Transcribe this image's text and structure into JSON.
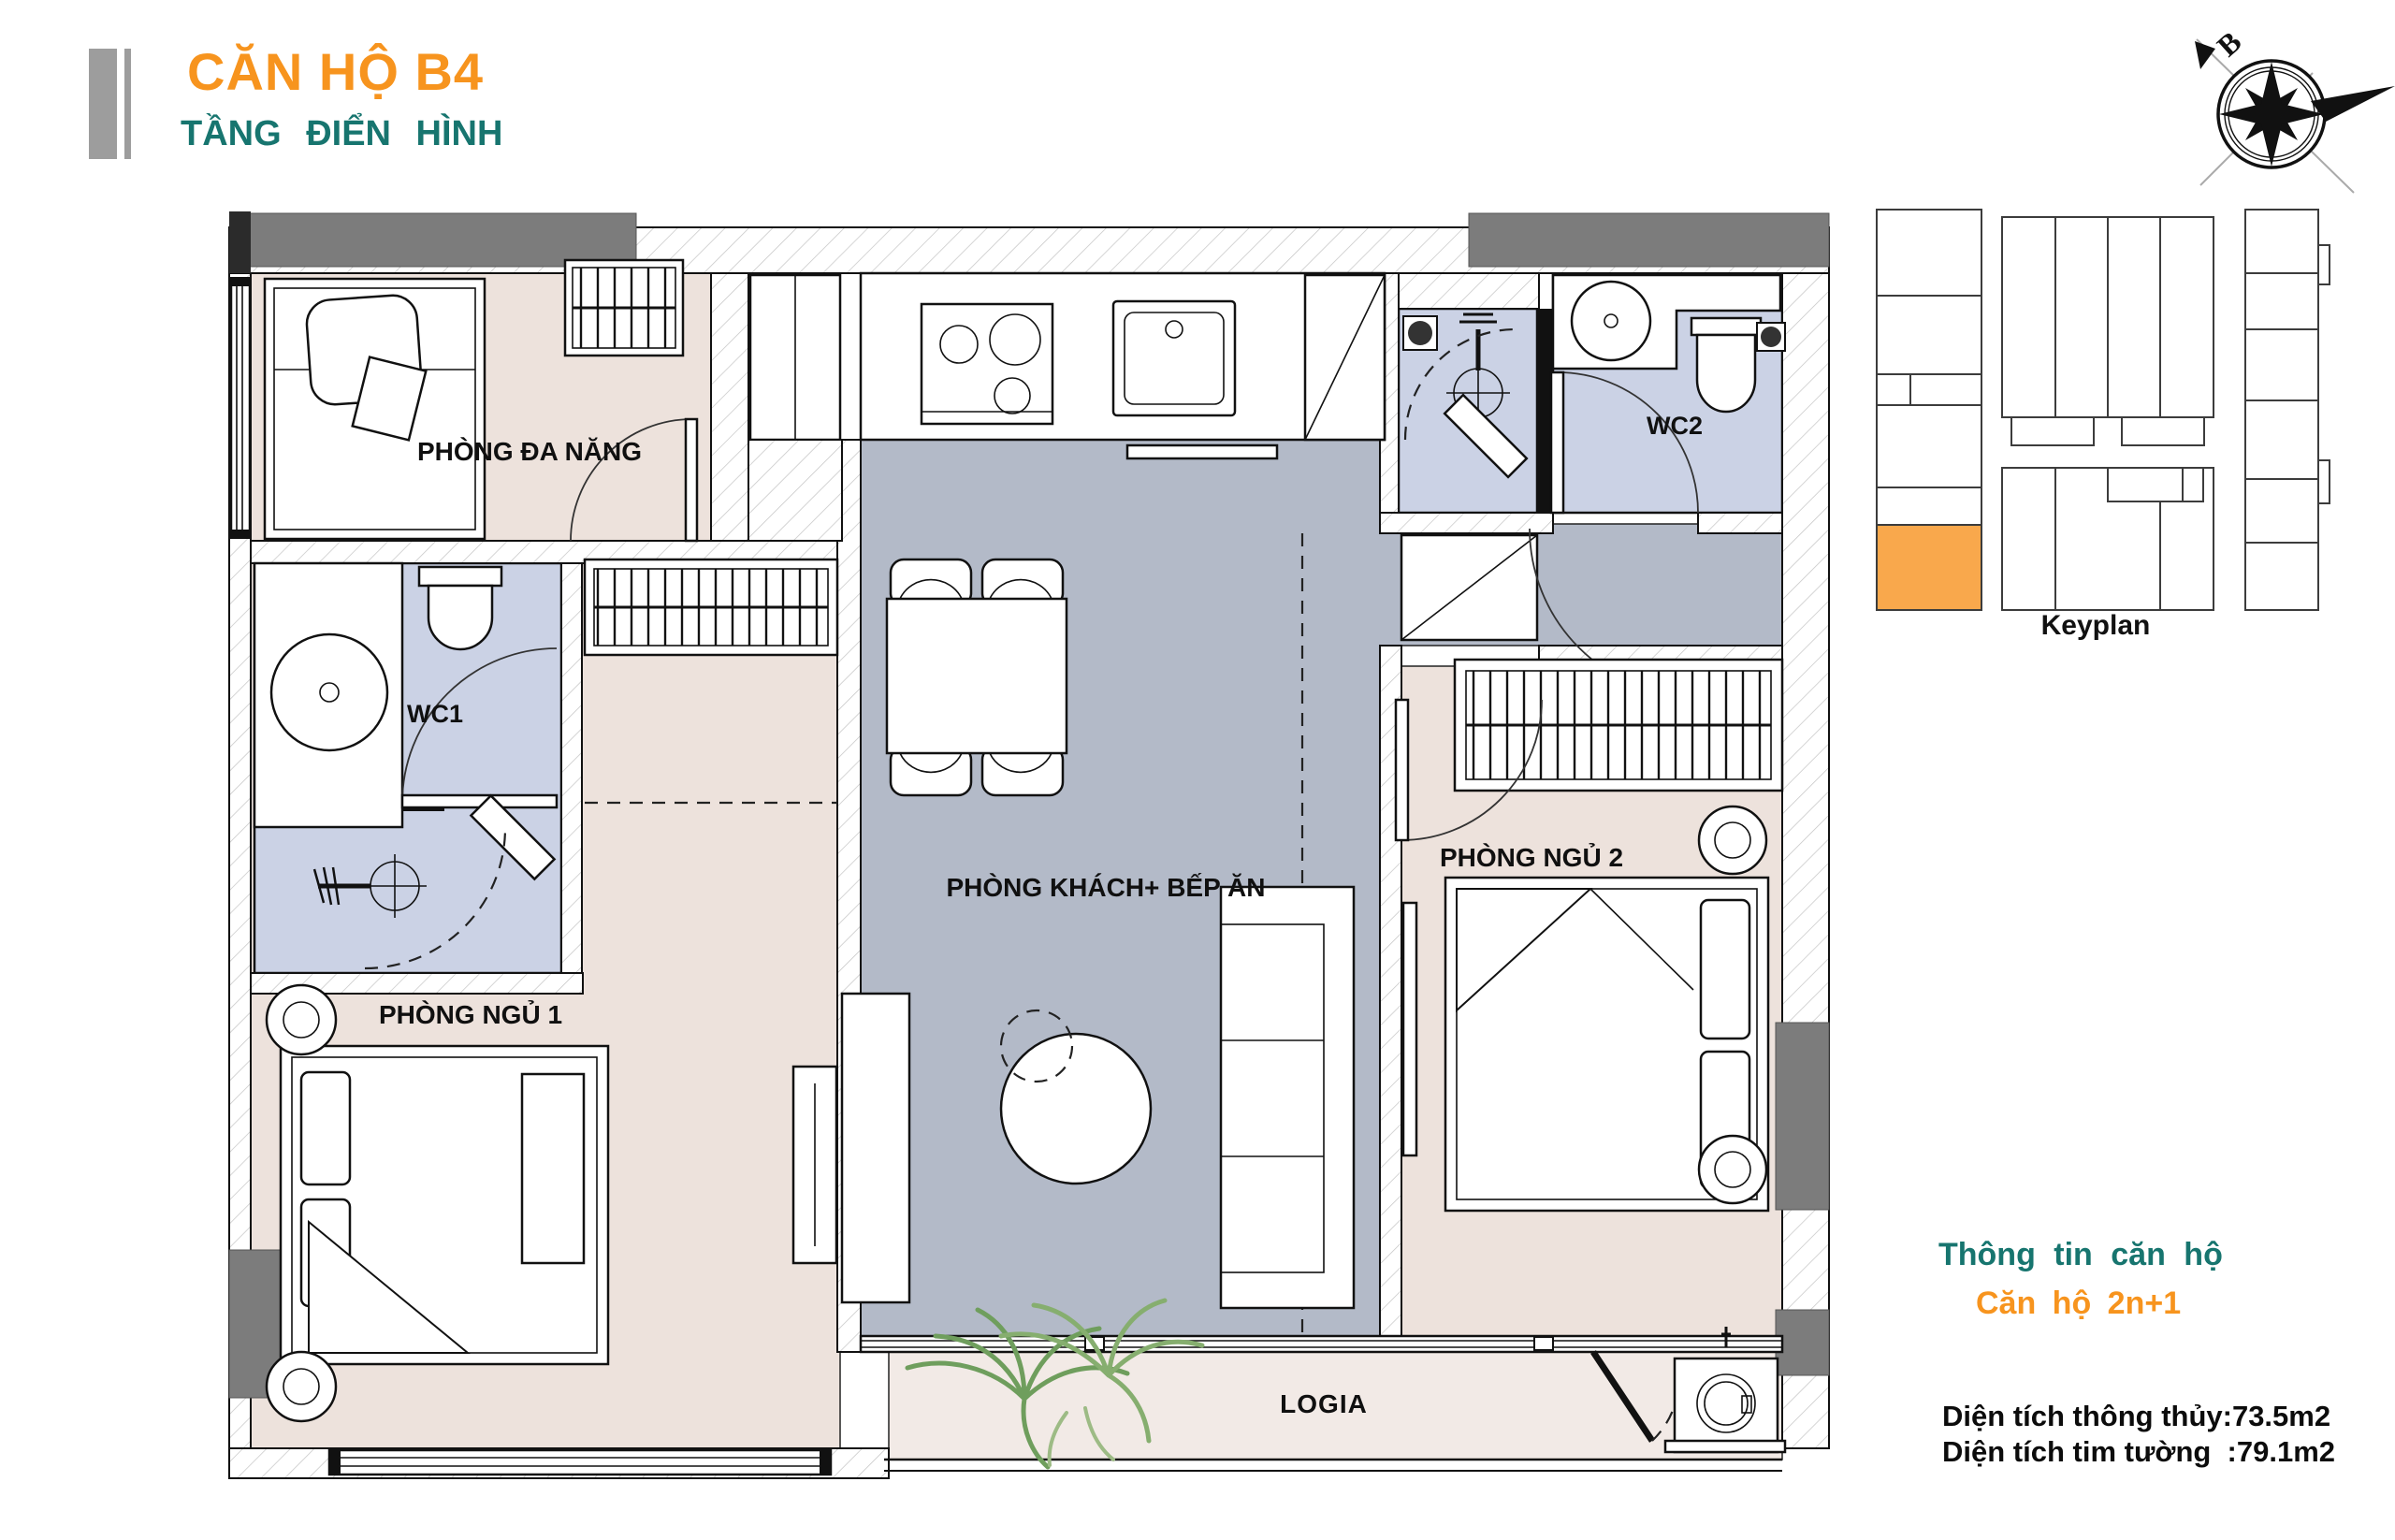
{
  "header": {
    "title": "CĂN HỘ B4",
    "subtitle": "TẦNG ĐIỂN HÌNH"
  },
  "compass": {
    "north_label": "B"
  },
  "keyplan": {
    "caption": "Keyplan"
  },
  "floorplan": {
    "rooms": {
      "multi_purpose": {
        "label": "PHÒNG ĐA NĂNG"
      },
      "living_kitchen": {
        "label": "PHÒNG KHÁCH+ BẾP ĂN"
      },
      "bedroom_1": {
        "label": "PHÒNG NGỦ 1"
      },
      "bedroom_2": {
        "label": "PHÒNG NGỦ 2"
      },
      "wc_1": {
        "label": "WC1"
      },
      "wc_2": {
        "label": "WC2"
      },
      "logia": {
        "label": "LOGIA"
      }
    },
    "colors": {
      "bedroom_floor": "#EDE2DC",
      "living_floor": "#B3BAC8",
      "wc_floor": "#CBD2E5",
      "logia_floor": "#F2EAE6",
      "wall_gray": "#7C7C7C",
      "keyplan_highlight": "#F9A84C",
      "accent_orange": "#F7941E",
      "accent_teal": "#17756F"
    }
  },
  "info": {
    "heading": "Thông tin căn hộ",
    "unit_type": "Căn hộ 2n+1",
    "area_net": "Diện tích thông thủy:73.5m2",
    "area_gross": "Diện tích tim tường  :79.1m2"
  }
}
